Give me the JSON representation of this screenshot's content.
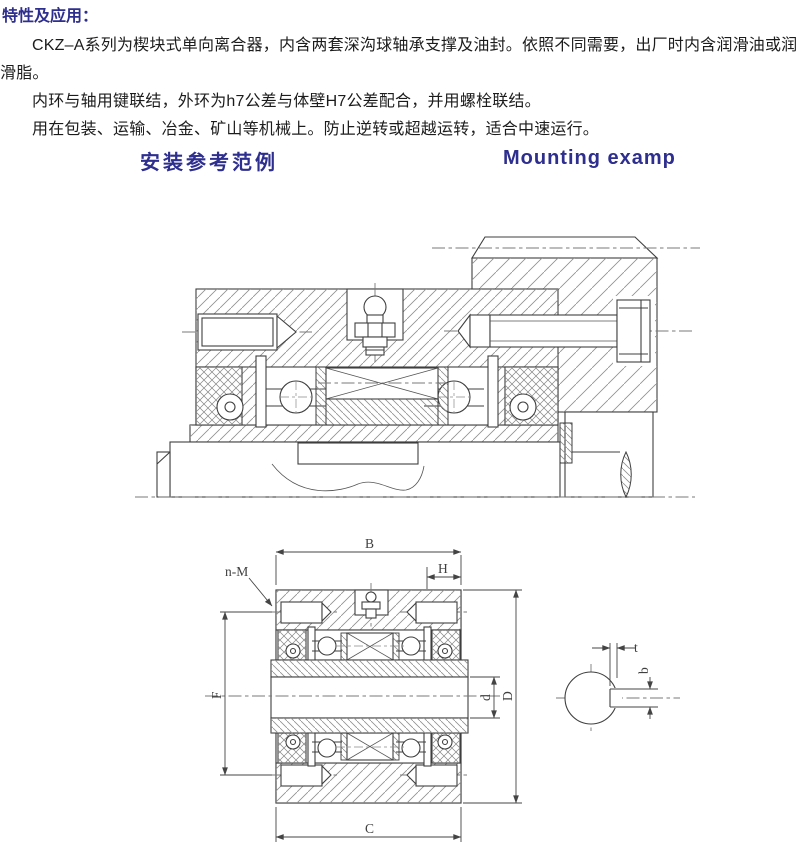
{
  "doc": {
    "title": "特性及应用：",
    "paragraphs": [
      "CKZ–A系列为楔块式单向离合器，内含两套深沟球轴承支撑及油封。依照不同需要，出厂时内含润滑油或润滑脂。",
      "内环与轴用键联结，外环为h7公差与体壁H7公差配合，并用螺栓联结。",
      "用在包装、运输、冶金、矿山等机械上。防止逆转或超越运转，适合中速运行。"
    ],
    "heading_zh": "安装参考范例",
    "heading_en": "Mounting examp"
  },
  "drawing": {
    "labels": {
      "B": "B",
      "H": "H",
      "nM": "n-M",
      "F": "F",
      "d": "d",
      "D": "D",
      "C": "C",
      "t": "t",
      "b": "b"
    }
  },
  "colors": {
    "heading": "#2e2e8f",
    "body_text": "#1c1c1c",
    "drawing_line": "#3f3f3f",
    "hatch": "#8f8f8f",
    "background": "#ffffff"
  }
}
